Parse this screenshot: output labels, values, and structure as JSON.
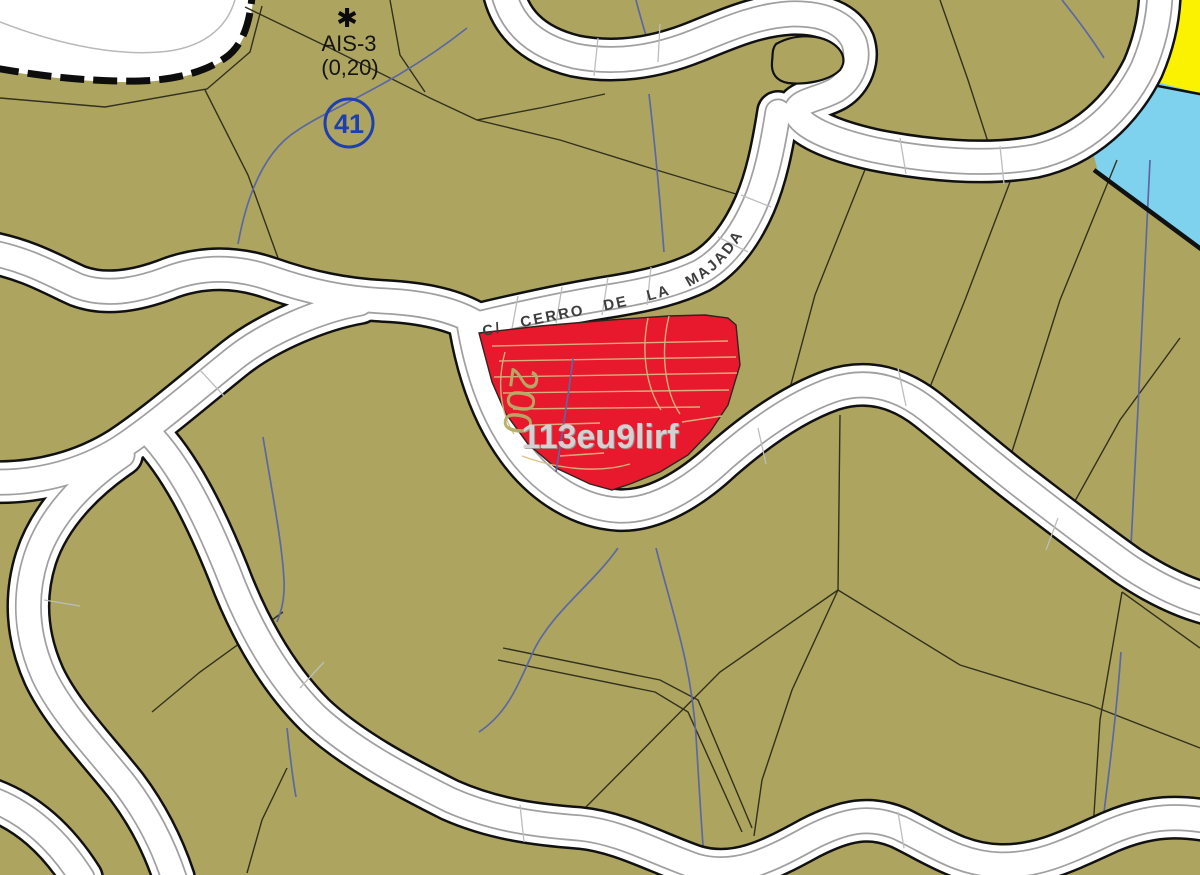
{
  "map": {
    "zone_label": {
      "marker": "✱",
      "name": "AIS-3",
      "coefficient": "(0,20)"
    },
    "parcel_number": "41",
    "street_name": "C/ CERRO DE LA MAJADA",
    "highlighted_parcel": {
      "reference": "113eu9lirf"
    },
    "contour_label": "200",
    "colors": {
      "land": "#ada55f",
      "road_fill": "#ffffff",
      "road_casing": "#111111",
      "highlight_red": "#e8192c",
      "zone_yellow": "#faf200",
      "zone_cyan": "#7fd2ee",
      "contour_blue": "#5b67a5",
      "reference_text": "#d2d2d2",
      "street_text": "#3d3d3d",
      "marker_blue": "#1e3fae",
      "excluded_zone": "#ffffff"
    }
  }
}
